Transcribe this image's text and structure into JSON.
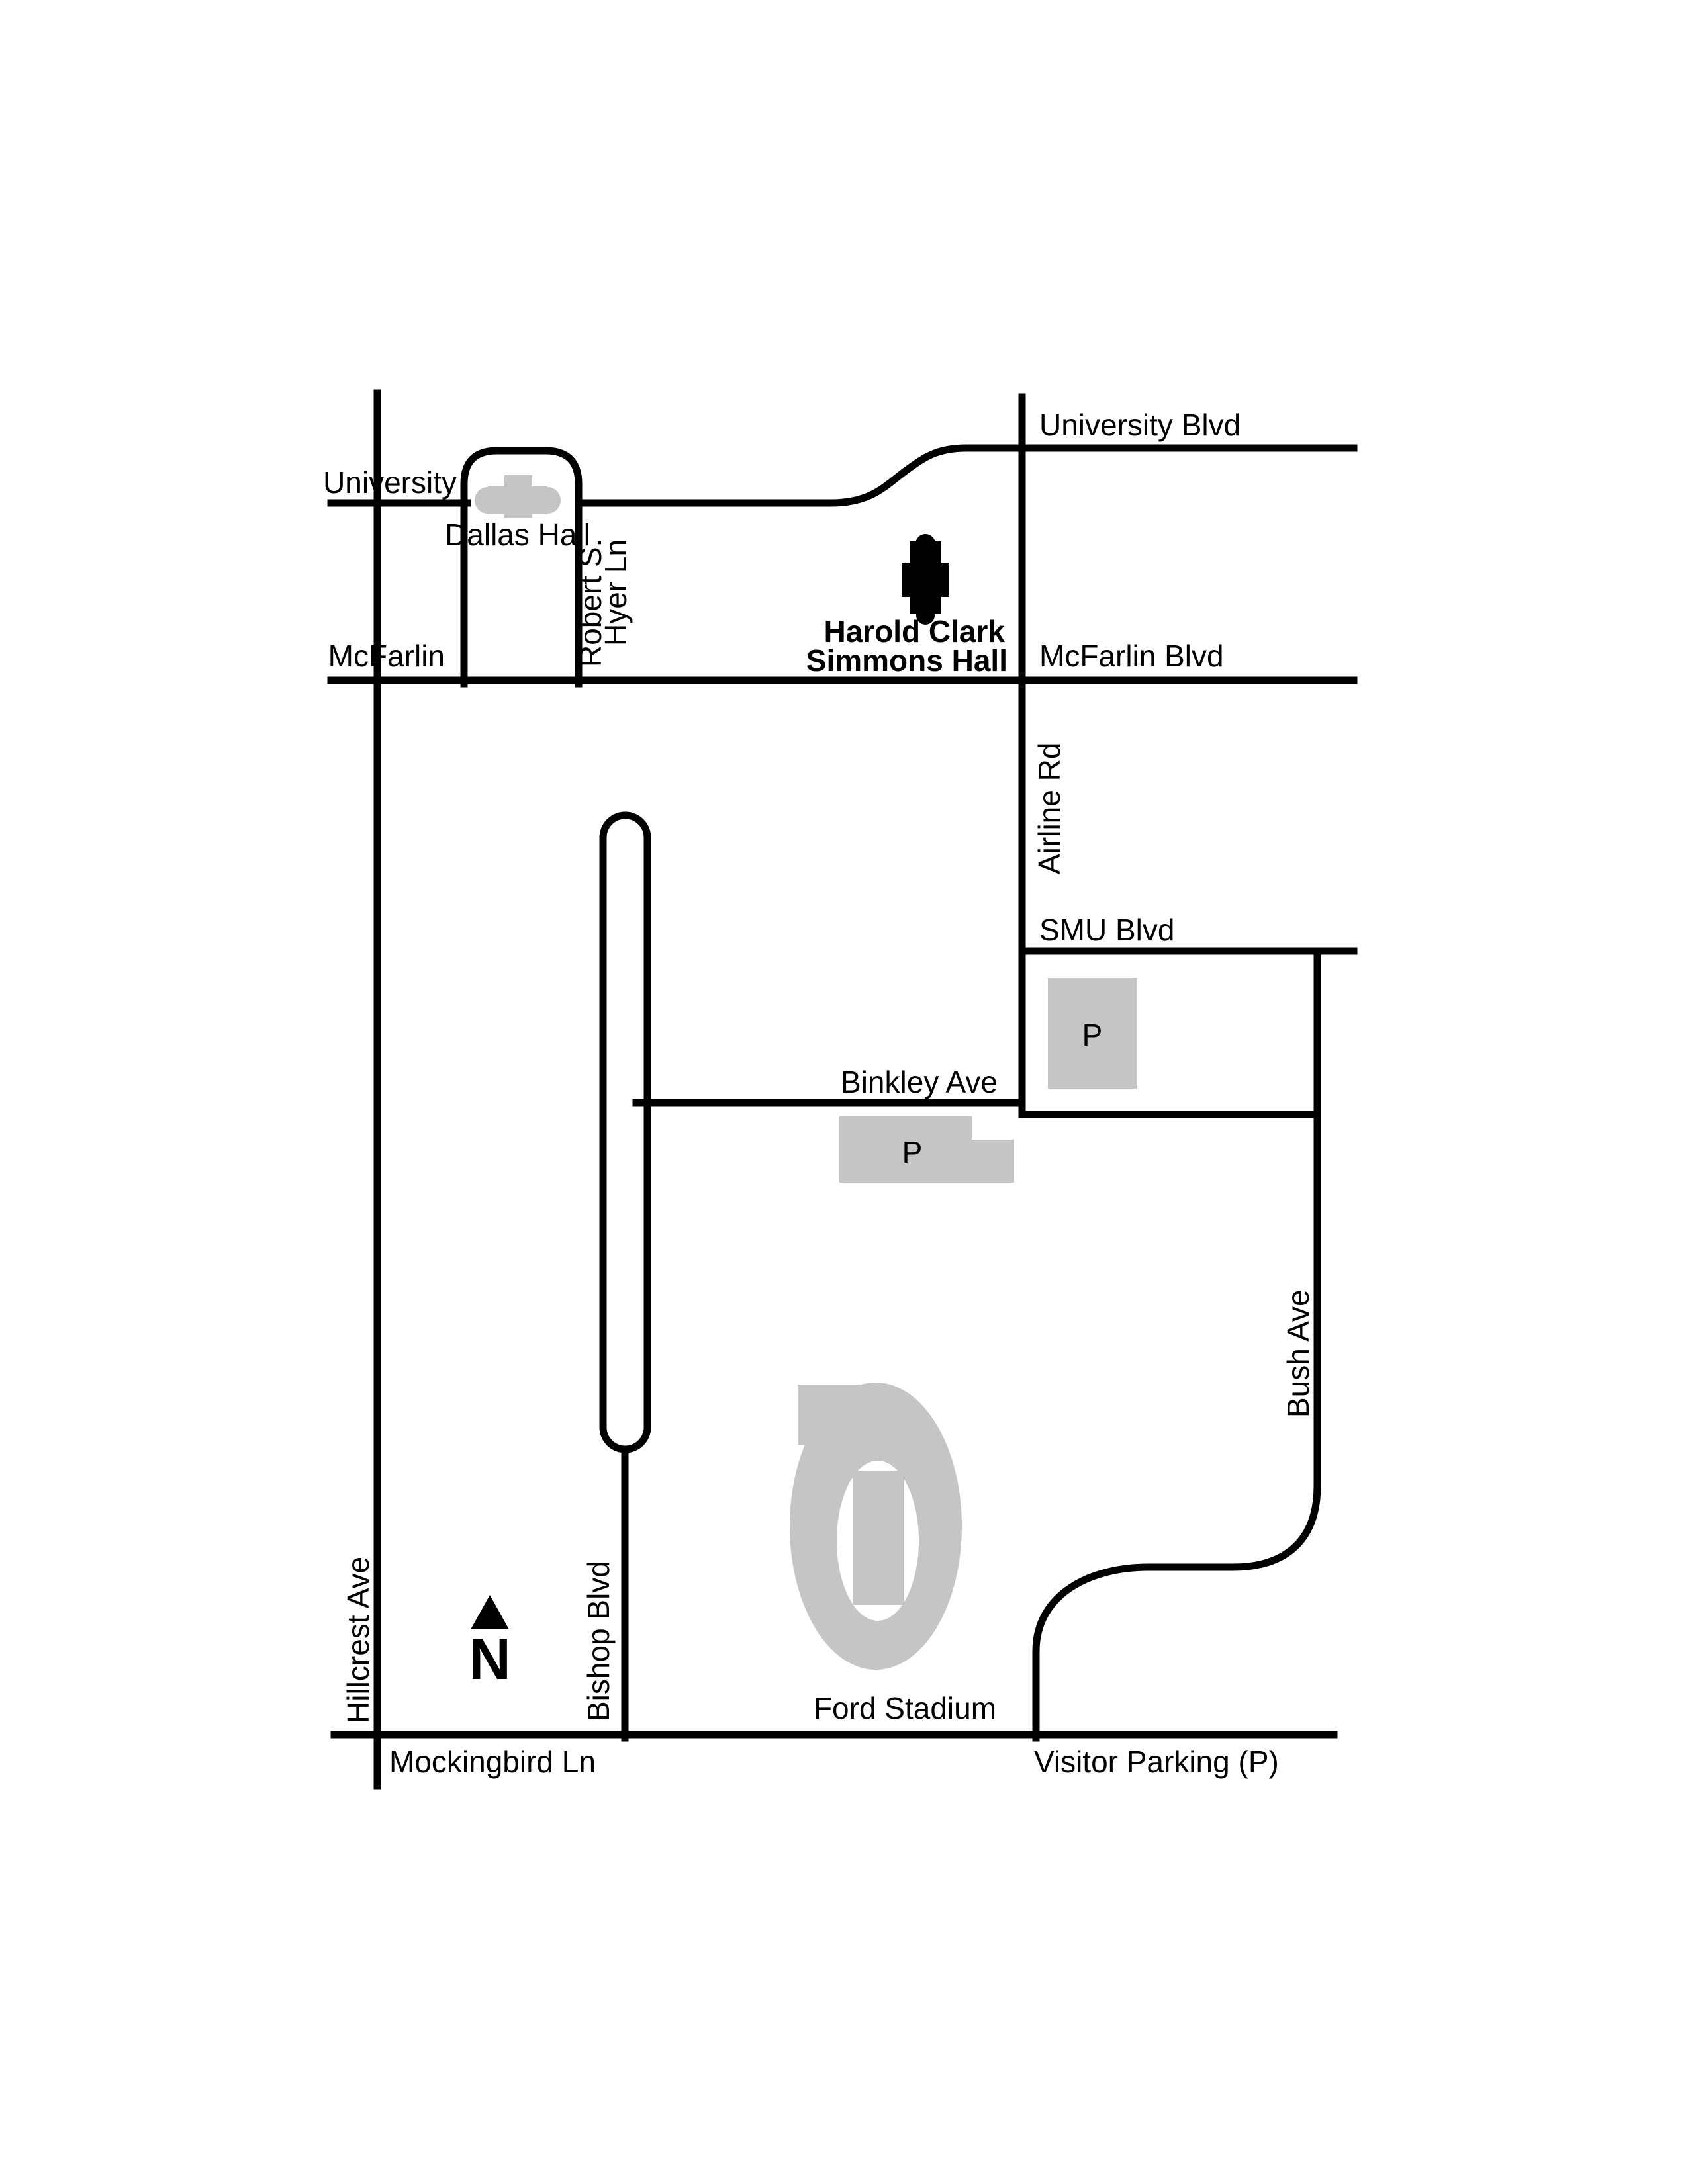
{
  "map": {
    "streets": {
      "university_blvd": "University Blvd",
      "university": "University",
      "mcfarlin": "McFarlin",
      "mcfarlin_blvd": "McFarlin Blvd",
      "robert_s_hyer_line1": "Robert S.",
      "robert_s_hyer_line2": "Hyer Ln",
      "airline_rd": "Airline Rd",
      "smu_blvd": "SMU Blvd",
      "binkley_ave": "Binkley Ave",
      "bush_ave": "Bush Ave",
      "bishop_blvd": "Bishop Blvd",
      "hillcrest_ave": "Hillcrest Ave",
      "mockingbird_ln": "Mockingbird Ln"
    },
    "buildings": {
      "dallas_hall": "Dallas Hall",
      "simmons_hall_line1": "Harold Clark",
      "simmons_hall_line2": "Simmons Hall",
      "ford_stadium": "Ford Stadium"
    },
    "parking": {
      "lot_symbol": "P",
      "legend": "Visitor Parking (P)"
    },
    "compass": {
      "north": "N"
    },
    "colors": {
      "roads": "#000000",
      "building_gray": "#c5c5c5",
      "building_highlight": "#000000",
      "background": "#ffffff"
    }
  }
}
